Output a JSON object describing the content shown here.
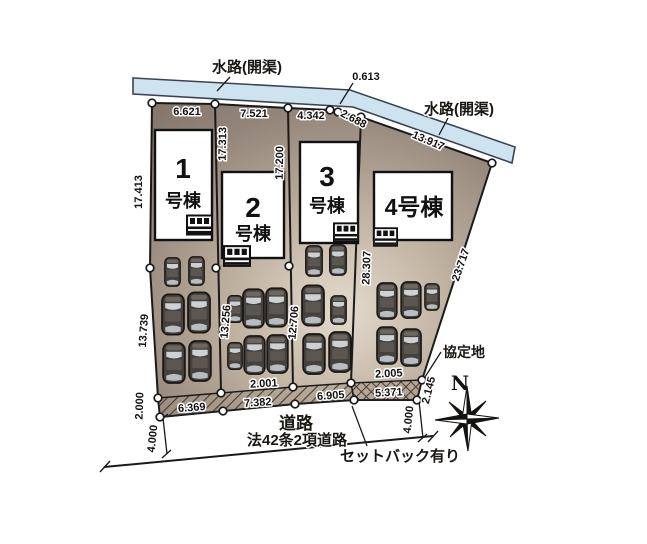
{
  "site": {
    "waterway": {
      "left_label": "水路(開渠)",
      "right_label": "水路(開渠)"
    },
    "road": {
      "label": "道路",
      "type_label": "法42条2項道路",
      "setback_label": "セットバック有り"
    },
    "agreement_label": "協定地",
    "compass_north": "N",
    "buildings": [
      {
        "number": "1",
        "suffix": "号棟"
      },
      {
        "number": "2",
        "suffix": "号棟"
      },
      {
        "number": "3",
        "suffix": "号棟"
      },
      {
        "number": "4号棟",
        "suffix": ""
      }
    ],
    "dimensions": {
      "top_lot1": "6.621",
      "top_lot2": "7.521",
      "top_lot3": "4.342",
      "top_gap": "0.613",
      "top_seg": "2.688",
      "top_diagonal": "13.917",
      "left_upper": "17.413",
      "left_lower": "13.739",
      "b12_upper": "17.313",
      "b12_lower": "13.256",
      "b23_upper": "17.200",
      "b23_lower": "12.706",
      "b34": "28.307",
      "right_diagonal": "23.717",
      "bottom_lot1": "6.369",
      "bottom_lot2": "7.382",
      "bottom_lot3": "6.905",
      "bottom_lot4": "5.371",
      "strip_lot2": "2.001",
      "strip_lot4": "2.005",
      "corner_right": "2.145",
      "road_width_left": "4.000",
      "road_width_right": "4.000",
      "setback_left": "2.000"
    },
    "colors": {
      "ground_dark": "#84766a",
      "ground_light": "#e4dbcd",
      "water_fill": "#cde4f0",
      "water_stroke": "#3a4450",
      "hatch_line": "#453a2f",
      "line": "#1a1a1a"
    }
  }
}
